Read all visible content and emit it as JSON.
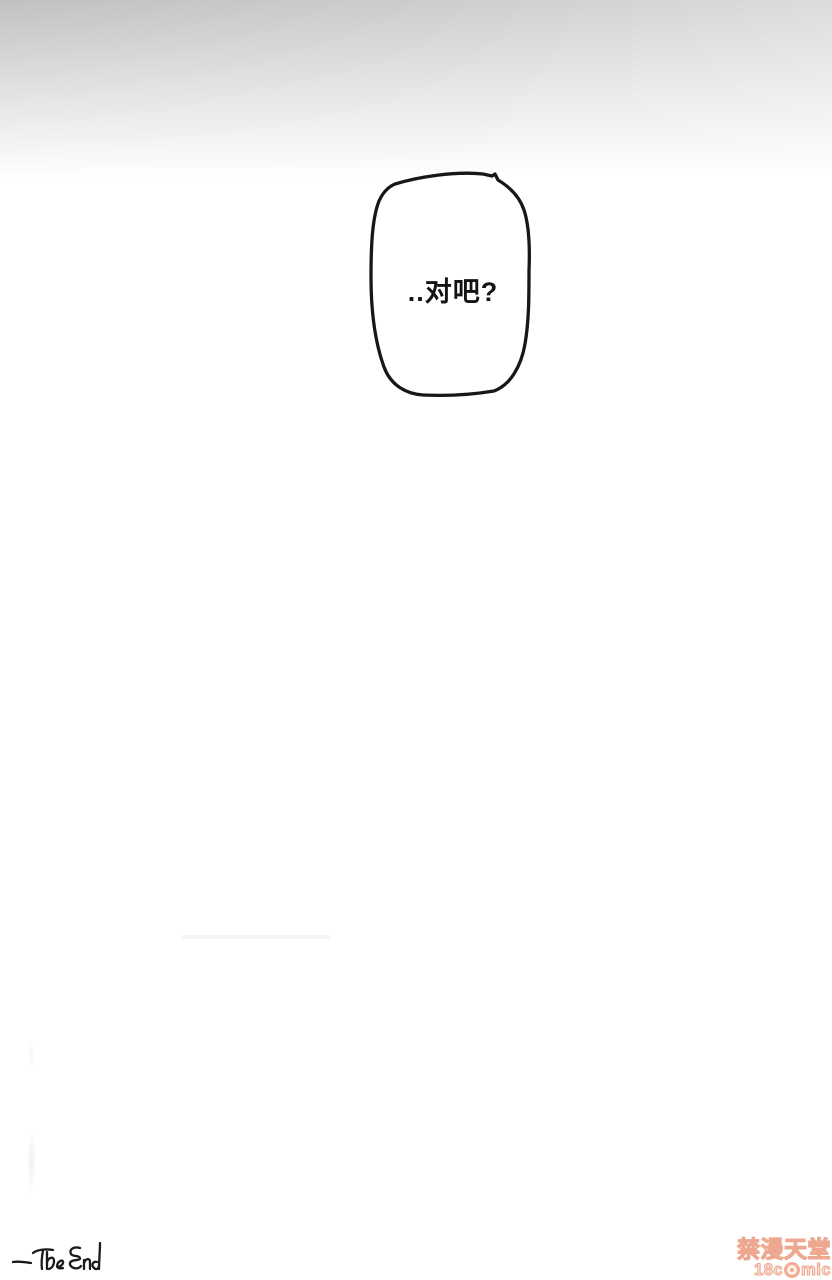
{
  "page": {
    "background_color": "#ffffff",
    "gradient_top_left_color": "#c1c1c1",
    "gradient_top_right_color": "#dcdcdc"
  },
  "speech_bubble": {
    "text": "..对吧?",
    "outline_color": "#171717"
  },
  "end_note": {
    "text": "-The End"
  },
  "watermark": {
    "line1": "禁漫天堂",
    "line2_prefix": "18c",
    "line2_suffix": "mic",
    "accent_color": "#efa890"
  }
}
